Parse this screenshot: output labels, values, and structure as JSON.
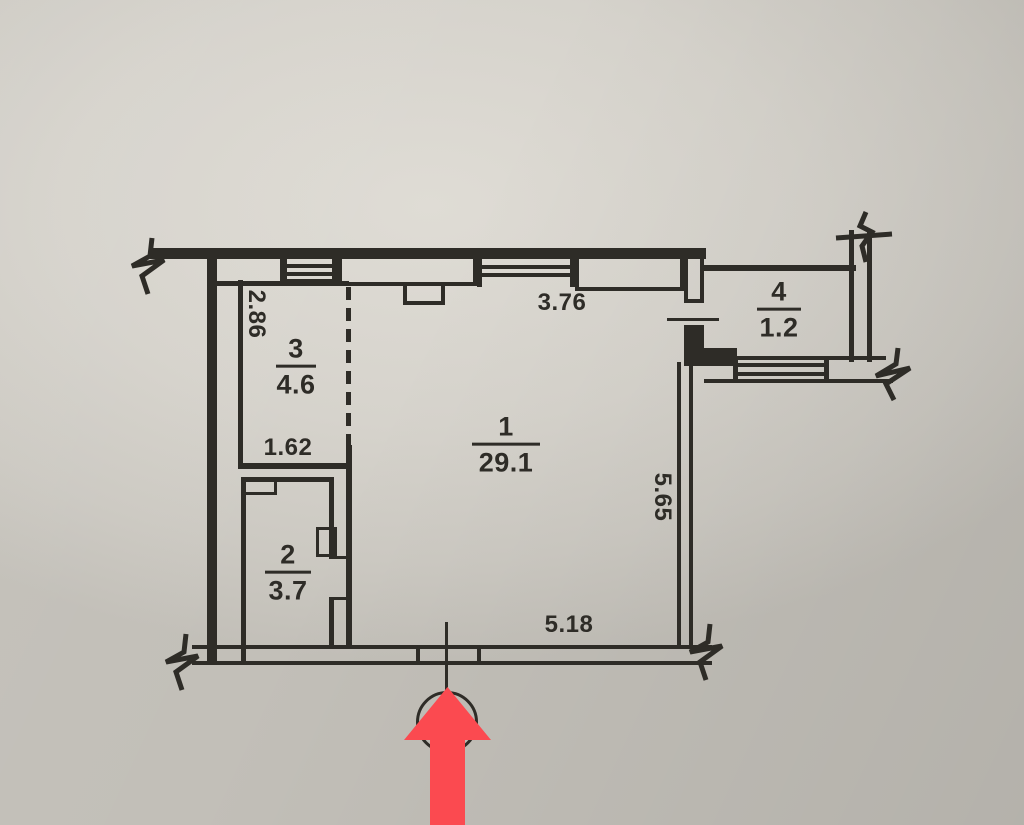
{
  "colors": {
    "paper": "#d6d3cc",
    "ink": "#2e2c27",
    "arrow_red": "#fb4a50"
  },
  "rooms": [
    {
      "number": "1",
      "area": "29.1"
    },
    {
      "number": "2",
      "area": "3.7"
    },
    {
      "number": "3",
      "area": "4.6"
    },
    {
      "number": "4",
      "area": "1.2"
    }
  ],
  "dims": {
    "room3_height": "2.86",
    "room3_width": "1.62",
    "room1_top_width": "3.76",
    "room1_right_height": "5.65",
    "room1_bottom_width": "5.18"
  },
  "icons": {
    "entrance_arrow": "red-up-arrow",
    "entrance_marker": "circle-axis-marker"
  }
}
